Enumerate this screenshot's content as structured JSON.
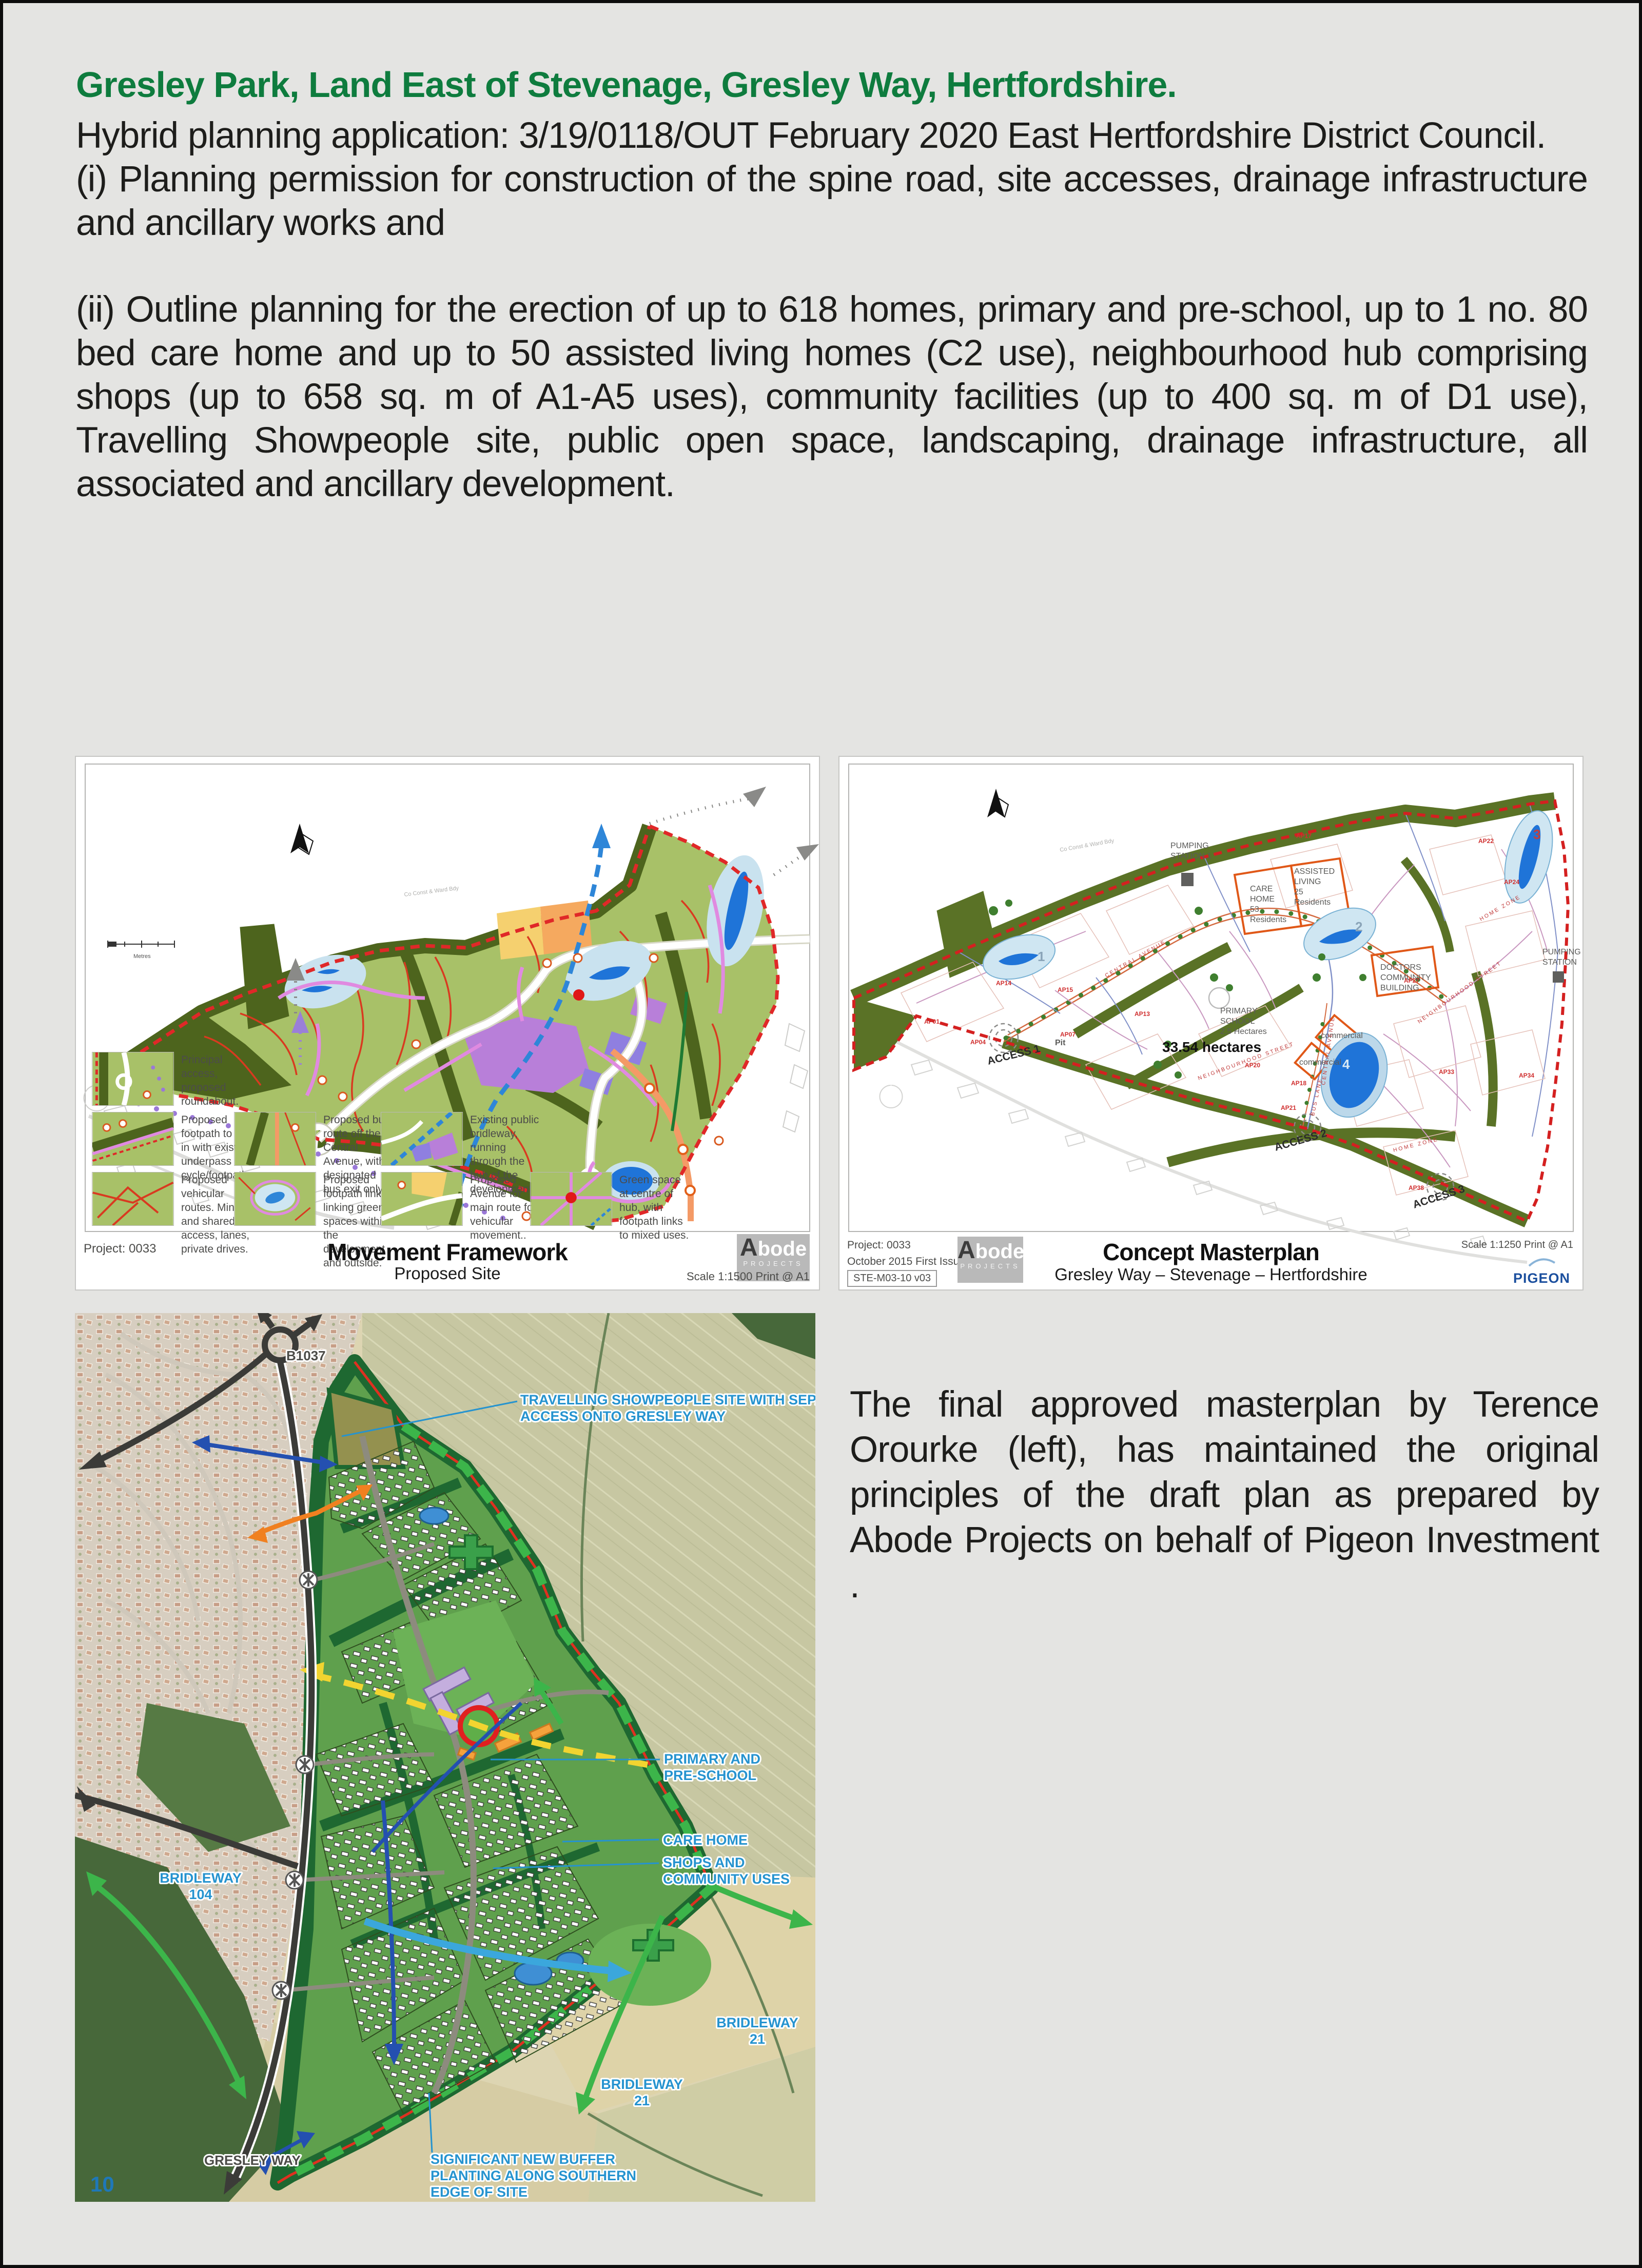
{
  "header": {
    "title": "Gresley Park, Land East of Stevenage, Gresley Way, Hertfordshire.",
    "intro": "Hybrid planning application: 3/19/0118/OUT February 2020 East Hertfordshire District Council.",
    "item_i": "(i) Planning permission for construction of the spine road, site accesses, drainage infrastructure and ancillary works and",
    "item_ii": "(ii) Outline planning for the erection of up to 618 homes, primary and pre-school, up to 1 no. 80 bed care home and up to 50 assisted living homes (C2 use), neighbourhood hub comprising shops (up to 658 sq. m of A1-A5 uses), community facilities (up to 400 sq. m of D1 use), Travelling Showpeople site, public open space, landscaping, drainage infrastructure, all associated and ancillary development."
  },
  "movement_framework": {
    "project": "Project: 0033",
    "title": "Movement Framework",
    "subtitle": "Proposed Site",
    "scale": "Scale 1:1500 Print @ A1",
    "boundary_note": "Co Const & Ward Bdy",
    "scalebar_label": "Metres",
    "logo": {
      "a": "A",
      "rest": "bode",
      "sub": "PROJECTS"
    },
    "legend": [
      "Principal access, proposed roundabout.",
      "Proposed footpath to link in with existing underpass cycle/footpath.",
      "Proposed vehicular routes. Minor and shared access, lanes, private drives.",
      "Proposed bus route off the Central Avenue, with designated bus exit only.",
      "Proposed footpath links linking green spaces within the development and outside.",
      "Existing public bridleway, running through the hub of the development.",
      "Proposed Avenue for main route for vehicular movement..",
      "Green space at centre of hub, with footpath links to mixed uses."
    ]
  },
  "concept_masterplan": {
    "project": "Project: 0033",
    "issue": "October 2015 First Issue",
    "ref": "STE-M03-10 v03",
    "title": "Concept Masterplan",
    "subtitle": "Gresley Way – Stevenage – Hertfordshire",
    "scale": "Scale 1:1250 Print @ A1",
    "pigeon": "PIGEON",
    "boundary_note": "Co Const & Ward Bdy",
    "area": "33.54 hectares",
    "labels": {
      "pumping1": [
        "PUMPING",
        "STATION 1"
      ],
      "care": [
        "CARE",
        "HOME",
        "53",
        "Residents"
      ],
      "assisted": [
        "ASSISTED",
        "LIVING",
        "25",
        "Residents"
      ],
      "school": [
        "PRIMARY",
        "SCHOOL",
        "2.5 Hectares"
      ],
      "doctors": [
        "DOCTORS",
        "COMMUNITY",
        "BUILDING"
      ],
      "commercial": "commercial",
      "pit": "Pit",
      "access1": "ACCESS 1",
      "access2": "ACCESS 2",
      "access3": "ACCESS 3",
      "pumping2": [
        "PUMPING",
        "STATION"
      ]
    },
    "street_names": {
      "central": "CENTRAL AVENUE",
      "neighbourhood": "NEIGHBOURHOOD STREET",
      "home": "HOME ZONE",
      "bus": "BUS LANE"
    },
    "lake_numbers": [
      "1",
      "2",
      "3",
      "4"
    ],
    "parcel_labels": [
      "AP01",
      "AP04",
      "AP07",
      "AP13",
      "AP14",
      "AP15",
      "AP17",
      "AP18",
      "AP20",
      "AP21",
      "AP22",
      "AP24",
      "AP27",
      "AP33",
      "AP34",
      "AP38"
    ]
  },
  "aerial": {
    "b1037": "B1037",
    "page_number": "10",
    "labels": {
      "showpeople": [
        "TRAVELLING SHOWPEOPLE SITE WITH SEPARATE",
        "ACCESS ONTO GRESLEY WAY"
      ],
      "school": [
        "PRIMARY AND",
        "PRE-SCHOOL"
      ],
      "care": "CARE HOME",
      "shops": [
        "SHOPS AND",
        "COMMUNITY USES"
      ],
      "bridleway104": [
        "BRIDLEWAY",
        "104"
      ],
      "bridleway21": [
        "BRIDLEWAY",
        "21"
      ],
      "gresley": "GRESLEY WAY",
      "buffer": [
        "SIGNIFICANT NEW BUFFER",
        "PLANTING ALONG SOUTHERN",
        "EDGE OF SITE"
      ]
    }
  },
  "caption": {
    "text": "The final approved masterplan by Terence Orourke (left), has maintained the original principles of the draft plan as prepared by Abode Projects on behalf of  Pigeon Investment ."
  }
}
